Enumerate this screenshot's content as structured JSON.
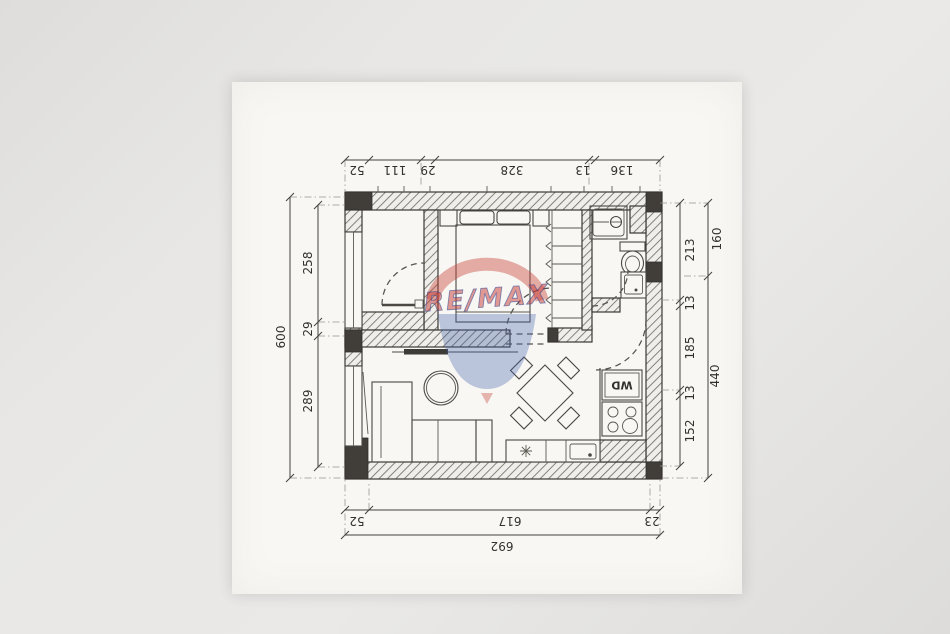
{
  "document": {
    "kind": "scanned apartment floor plan"
  },
  "dimensions": {
    "top": [
      "52",
      "111",
      "29",
      "328",
      "13",
      "136"
    ],
    "left": {
      "overall": "600",
      "segments": [
        "258",
        "29",
        "289"
      ]
    },
    "right": {
      "segments": [
        "213",
        "13",
        "185",
        "13",
        "152"
      ],
      "outer": [
        "160",
        "440"
      ]
    },
    "bottom": {
      "segments": [
        "52",
        "617",
        "23"
      ],
      "overall": "692"
    }
  },
  "labels": {
    "washer_dryer": "WD"
  },
  "watermark": {
    "brand": "RE/MAX",
    "colors": {
      "red": "#c9423 7",
      "balloon_red": "#c94237",
      "balloon_blue": "#4462a8"
    }
  }
}
